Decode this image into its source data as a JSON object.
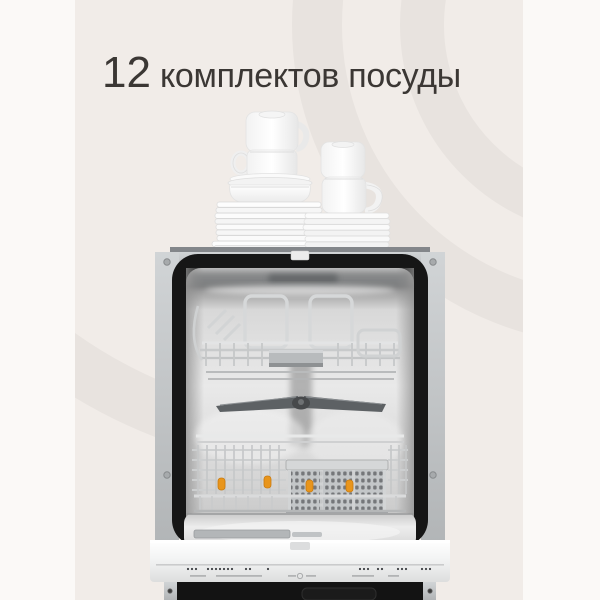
{
  "headline": {
    "number": "12",
    "text": "комплектов посуды"
  },
  "colors": {
    "page_bg": "#fbf9f7",
    "panel_bg": "#f1ece8",
    "swirl": "#e8e3df",
    "headline_text": "#3b3734",
    "clip_orange": "#e8951c",
    "clip_orange_dark": "#c97b10",
    "frame_gray": "#bfc2c4",
    "tub_black": "#161616",
    "steel_light": "#ececec",
    "door_white": "#f5f6f6",
    "plinth_black": "#131313"
  }
}
